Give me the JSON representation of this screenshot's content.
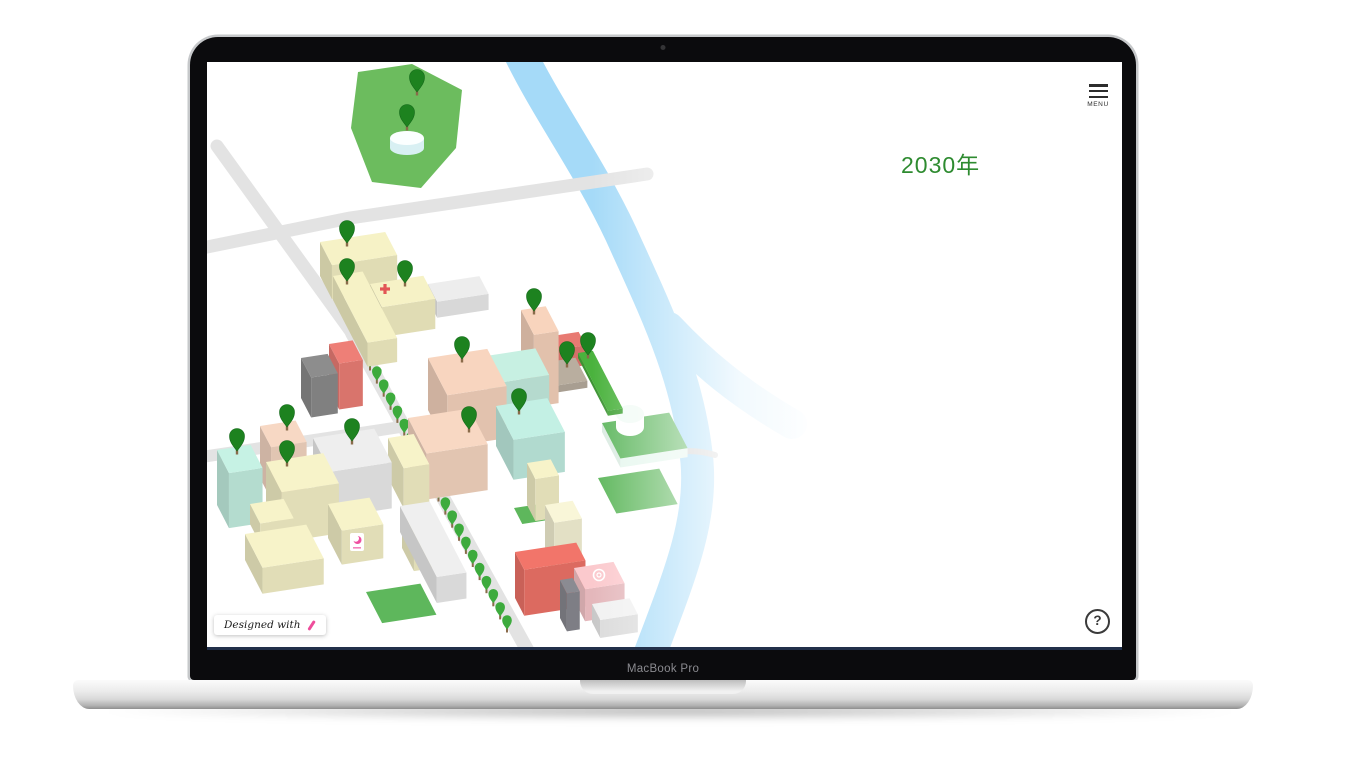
{
  "device": {
    "label": "MacBook Pro"
  },
  "screen_ui": {
    "menu": {
      "label": "MENU",
      "icon": "hamburger-icon"
    },
    "year_label": "2030年",
    "help_label": "?",
    "badge": {
      "text": "Designed with",
      "icon": "pen-icon"
    }
  },
  "palette": {
    "accent_green": "#2e8b30",
    "pin": "#1d821f",
    "pin_outline": "#14691a",
    "tree": "#3dab3d",
    "trunk": "#8a6b4a",
    "river": "#a5daf8",
    "road": "#e3e3e3",
    "footbridge": "#cfcfcf",
    "park": "#6cbc5e",
    "field": "#5eb75c",
    "cross_red": "#e25555",
    "crescent_pink": "#ee4fa0",
    "pen_pink": "#ee4d9b"
  },
  "map": {
    "park": {
      "points": [
        [
          151,
          10
        ],
        [
          205,
          2
        ],
        [
          255,
          28
        ],
        [
          249,
          86
        ],
        [
          214,
          126
        ],
        [
          165,
          120
        ],
        [
          144,
          66
        ]
      ],
      "pond": {
        "cx": 200,
        "cy": 76,
        "rx": 17,
        "ry": 7,
        "h": 10,
        "top": "#fbffff",
        "side": "#d8f0f3"
      }
    },
    "river": {
      "main": "M310,-15 C340,48 380,100 414,172 C447,245 482,315 490,400 C495,460 472,515 443,592",
      "main_width": 33,
      "branch": "M462,265 C495,300 530,330 585,362",
      "branch_width": 30
    },
    "footbridge": {
      "d": "M452,396 Q477,384 508,393",
      "width": 6
    },
    "roads": [
      {
        "id": "northwest-road",
        "pts": [
          [
            10,
            84
          ],
          [
            145,
            271
          ]
        ],
        "w": 13
      },
      {
        "id": "tree-avenue-road",
        "pts": [
          [
            145,
            271
          ],
          [
            323,
            593
          ]
        ],
        "w": 14
      },
      {
        "id": "bridge-road",
        "pts": [
          [
            -10,
            187
          ],
          [
            143,
            156
          ],
          [
            353,
            125
          ],
          [
            440,
            112
          ]
        ],
        "w": 13
      },
      {
        "id": "west-road",
        "pts": [
          [
            -12,
            396
          ],
          [
            200,
            364
          ]
        ],
        "w": 12
      }
    ],
    "fields": [
      {
        "x": 391,
        "y": 416,
        "a": 62,
        "b": 40
      },
      {
        "x": 307,
        "y": 446,
        "a": 32,
        "b": 18
      },
      {
        "x": 159,
        "y": 530,
        "a": 55,
        "b": 35
      }
    ],
    "deck": {
      "x": 395,
      "y": 370,
      "a": 68,
      "b": 40,
      "h": 9,
      "top": "#5fb75f",
      "side": "#e6f7ee"
    },
    "deck_cylinder": {
      "cx": 423,
      "cy": 352,
      "rx": 14,
      "ry": 9,
      "h": 13,
      "top": "#f2fbf6",
      "side": "#ffffff"
    },
    "trees": {
      "from": [
        163,
        308
      ],
      "to": [
        300,
        570
      ],
      "count": 21
    },
    "buildings": [
      {
        "id": "hall-a",
        "x": 113,
        "y": 214,
        "a": 66,
        "b": 26,
        "h": 34,
        "color": "#f6f2c6"
      },
      {
        "id": "hall-b",
        "x": 126,
        "y": 238,
        "a": 30,
        "b": 75,
        "h": 24,
        "color": "#f6f2c6"
      },
      {
        "id": "hospital",
        "x": 163,
        "y": 252,
        "a": 54,
        "b": 26,
        "h": 30,
        "color": "#f6f2c6"
      },
      {
        "id": "depot",
        "x": 221,
        "y": 238,
        "a": 52,
        "b": 20,
        "h": 16,
        "color": "#ededed"
      },
      {
        "id": "gray-office",
        "x": 94,
        "y": 336,
        "a": 27,
        "b": 22,
        "h": 40,
        "color": "#8d8d8d"
      },
      {
        "id": "red-office",
        "x": 122,
        "y": 328,
        "a": 24,
        "b": 22,
        "h": 46,
        "color": "#ee7f77"
      },
      {
        "id": "river-tower",
        "x": 314,
        "y": 320,
        "a": 25,
        "b": 28,
        "h": 72,
        "color": "#f8d4bd"
      },
      {
        "id": "red-annex",
        "x": 345,
        "y": 294,
        "a": 27,
        "b": 15,
        "h": 20,
        "color": "#e87a72"
      },
      {
        "id": "plaza",
        "x": 321,
        "y": 310,
        "a": 48,
        "b": 26,
        "h": 7,
        "color": "#b9ae9f"
      },
      {
        "id": "green-lane",
        "x": 371,
        "y": 296,
        "a": 15,
        "b": 65,
        "h": 5,
        "color": "#4ab23d"
      },
      {
        "id": "mint-low",
        "x": 279,
        "y": 324,
        "a": 50,
        "b": 30,
        "h": 30,
        "color": "#c7f0e2"
      },
      {
        "id": "mint-tower",
        "x": 289,
        "y": 384,
        "a": 52,
        "b": 38,
        "h": 40,
        "color": "#c3f0e4"
      },
      {
        "id": "peach-tower-a",
        "x": 221,
        "y": 348,
        "a": 60,
        "b": 42,
        "h": 52,
        "color": "#f8d5bf"
      },
      {
        "id": "peach-tower-b",
        "x": 201,
        "y": 402,
        "a": 62,
        "b": 40,
        "h": 46,
        "color": "#f8d8c3"
      },
      {
        "id": "mint-corner",
        "x": 10,
        "y": 443,
        "a": 34,
        "b": 26,
        "h": 55,
        "color": "#c6f2e4"
      },
      {
        "id": "peach-corner",
        "x": 53,
        "y": 416,
        "a": 36,
        "b": 24,
        "h": 52,
        "color": "#f7d8c4"
      },
      {
        "id": "yellow-corner",
        "x": 59,
        "y": 450,
        "a": 58,
        "b": 34,
        "h": 50,
        "color": "#f7f3c9"
      },
      {
        "id": "white-block",
        "x": 106,
        "y": 422,
        "a": 62,
        "b": 38,
        "h": 46,
        "color": "#eeeeee"
      },
      {
        "id": "yellow-small",
        "x": 43,
        "y": 462,
        "a": 34,
        "b": 22,
        "h": 20,
        "color": "#f7f3c9"
      },
      {
        "id": "yellow-l",
        "x": 38,
        "y": 498,
        "a": 62,
        "b": 38,
        "h": 26,
        "color": "#f7f3c9"
      },
      {
        "id": "store",
        "x": 121,
        "y": 476,
        "a": 42,
        "b": 30,
        "h": 34,
        "color": "#f7f3c9"
      },
      {
        "id": "yellow-mid",
        "x": 195,
        "y": 486,
        "a": 34,
        "b": 26,
        "h": 28,
        "color": "#f7f3c9"
      },
      {
        "id": "yellow-tall",
        "x": 181,
        "y": 416,
        "a": 26,
        "b": 34,
        "h": 40,
        "color": "#f7f3c9"
      },
      {
        "id": "white-long",
        "x": 193,
        "y": 470,
        "a": 30,
        "b": 80,
        "h": 26,
        "color": "#efefef"
      },
      {
        "id": "cream-a",
        "x": 320,
        "y": 443,
        "a": 24,
        "b": 18,
        "h": 42,
        "color": "#f7f3c9"
      },
      {
        "id": "cream-b",
        "x": 338,
        "y": 498,
        "a": 28,
        "b": 20,
        "h": 55,
        "color": "#f9f6d8"
      },
      {
        "id": "red-hall",
        "x": 308,
        "y": 536,
        "a": 62,
        "b": 20,
        "h": 46,
        "color": "#f2756a"
      },
      {
        "id": "gray-slim",
        "x": 353,
        "y": 556,
        "a": 13,
        "b": 15,
        "h": 38,
        "color": "#8b8b92"
      },
      {
        "id": "pink-studio",
        "x": 367,
        "y": 538,
        "a": 40,
        "b": 24,
        "h": 32,
        "color": "#fbc9cd"
      },
      {
        "id": "white-annex",
        "x": 385,
        "y": 560,
        "a": 38,
        "b": 18,
        "h": 18,
        "color": "#f1f1f1"
      }
    ],
    "decals": [
      {
        "type": "red-cross",
        "x": 178,
        "y": 227
      },
      {
        "type": "crescent",
        "x": 150,
        "y": 480
      },
      {
        "type": "circle-mark",
        "x": 392,
        "y": 513
      }
    ],
    "pins": [
      [
        210,
        33
      ],
      [
        200,
        68
      ],
      [
        140,
        184
      ],
      [
        140,
        222
      ],
      [
        198,
        224
      ],
      [
        327,
        252
      ],
      [
        381,
        296
      ],
      [
        360,
        305
      ],
      [
        255,
        300
      ],
      [
        312,
        352
      ],
      [
        262,
        370
      ],
      [
        80,
        368
      ],
      [
        30,
        392
      ],
      [
        80,
        404
      ],
      [
        145,
        382
      ]
    ],
    "fade": {
      "x_start": 385,
      "x_full": 650
    }
  }
}
